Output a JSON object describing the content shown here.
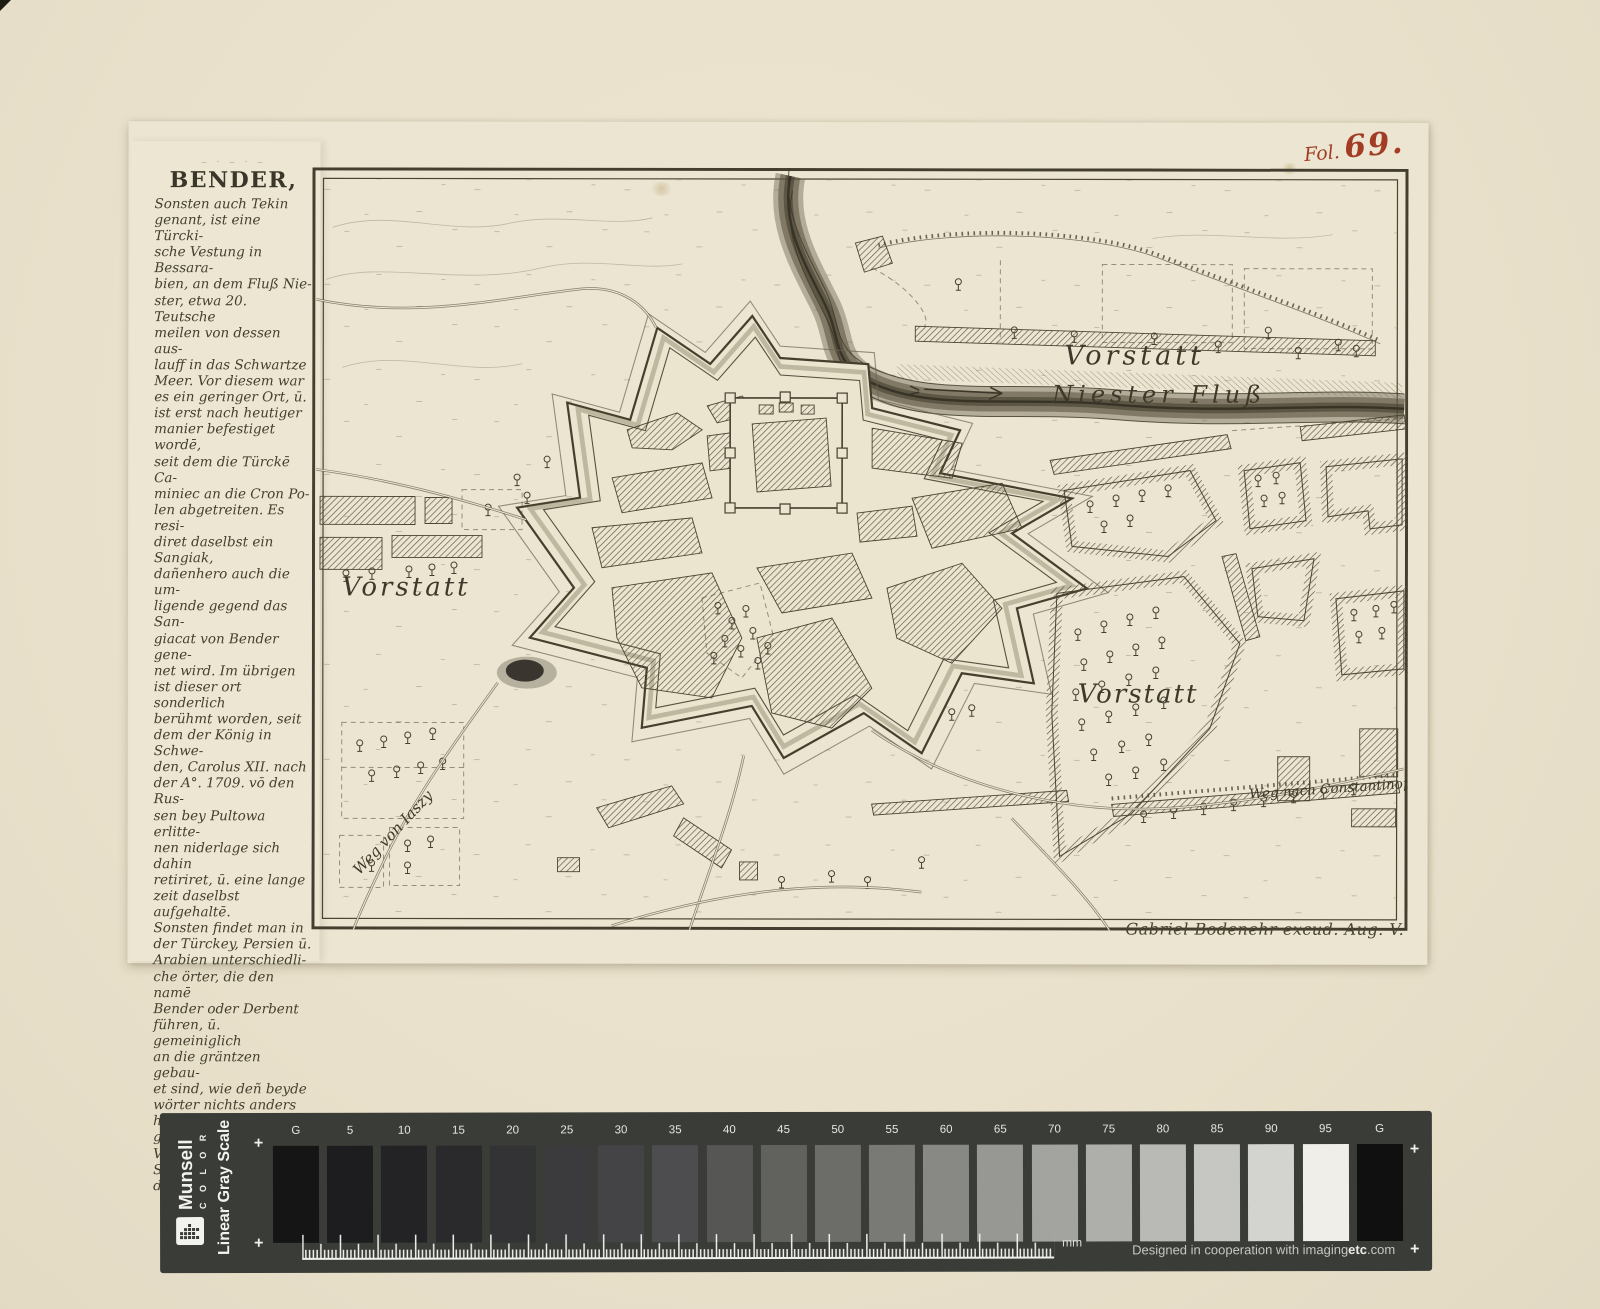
{
  "folio": {
    "prefix": "Fol.",
    "number": "69."
  },
  "description_panel": {
    "title": "BENDER,",
    "body": "Sonsten auch Tekin\ngenant, ist eine Türcki-\nsche Vestung in Bessara-\nbien, an dem Fluß Nie-\nster, etwa 20. Teutsche\nmeilen von dessen aus-\nlauff in das Schwartze\nMeer. Vor diesem war\nes ein geringer Ort, ū.\nist erst nach heutiger\nmanier befestiget wordē,\nseit dem die Türckē Ca-\nminiec an die Cron Po-\nlen abgetreiten. Es resi-\ndiret daselbst ein Sangiak,\ndañenhero auch die um-\nligende gegend das San-\ngiacat von Bender gene-\nnet wird. Im übrigen\nist dieser ort sonderlich\nberühmt worden, seit\ndem der König in Schwe-\nden, Carolus XII. nach\nder A°. 1709. vō den Rus-\nsen bey Pultowa erlitte-\nnen niderlage sich dahin\nretiriret, ū. eine lange\nzeit daselbst aufgehaltē.\nSonsten findet man in\nder Türckey, Persien ū.\nArabien unterschiedli-\nche örter, die den namē\nBender oder Derbent\nführen, ū. gemeiniglich\nan die gräntzen gebau-\net sind, wie deñ beyde\nwörter nichts anders\nheyssen, als eine gräntz-\nVestung oder Schlüssel\ndes Reichs."
  },
  "map": {
    "labels": {
      "vorstatt_north": "Vorstatt",
      "niester_fluss": "Niester Fluß",
      "vorstatt_west": "Vorstatt",
      "vorstatt_southeast": "Vorstatt",
      "weg_von_iaszy": "Weg von Iaszy",
      "weg_nach_constantinopel": "Weg nach Constantinopel"
    },
    "imprint": "Gabriel Bodenehr excud. Aug. V."
  },
  "grayscale_bar": {
    "brand": {
      "name": "Munsell",
      "subname": "C O L O R",
      "scale_name": "Linear Gray Scale"
    },
    "plus_mark": "+",
    "ruler_unit": "mm",
    "credit": {
      "part1": "Designed in cooperation with imaging",
      "part2": "etc",
      "part3": ".com"
    },
    "patches": [
      {
        "label": "G",
        "hex": "#151515"
      },
      {
        "label": "5",
        "hex": "#1d1d1f"
      },
      {
        "label": "10",
        "hex": "#232326"
      },
      {
        "label": "15",
        "hex": "#2a2a2d"
      },
      {
        "label": "20",
        "hex": "#333335"
      },
      {
        "label": "25",
        "hex": "#3b3b3d"
      },
      {
        "label": "30",
        "hex": "#444446"
      },
      {
        "label": "35",
        "hex": "#4d4d4f"
      },
      {
        "label": "40",
        "hex": "#565654"
      },
      {
        "label": "45",
        "hex": "#61615d"
      },
      {
        "label": "50",
        "hex": "#6c6c68"
      },
      {
        "label": "55",
        "hex": "#797975"
      },
      {
        "label": "60",
        "hex": "#888884"
      },
      {
        "label": "65",
        "hex": "#979793"
      },
      {
        "label": "70",
        "hex": "#a3a39f"
      },
      {
        "label": "75",
        "hex": "#aeaeaa"
      },
      {
        "label": "80",
        "hex": "#b9b9b5"
      },
      {
        "label": "85",
        "hex": "#c6c6c2"
      },
      {
        "label": "90",
        "hex": "#d3d3cf"
      },
      {
        "label": "95",
        "hex": "#efeee8"
      },
      {
        "label": "G",
        "hex": "#101010"
      }
    ]
  },
  "colors": {
    "mat_background": "#e9e1cb",
    "paper": "#ebe5d1",
    "engraving_ink": "#453f2e",
    "red_ink": "#a23c25",
    "bar_background": "#3a3c37"
  }
}
